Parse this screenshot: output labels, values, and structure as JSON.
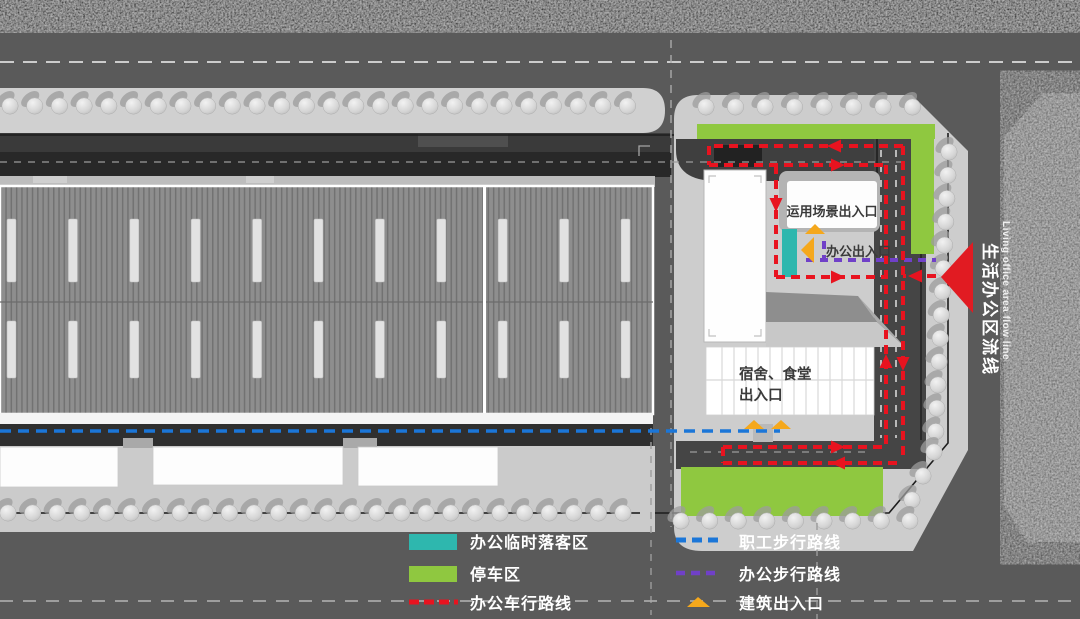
{
  "plan": {
    "labels": {
      "scene_entrance": "运用场景出入口",
      "office_entrance": "办公出入口",
      "dorm_line1": "宿舍、食堂",
      "dorm_line2": "出入口",
      "flow_cn": "生活办公区流线",
      "flow_en": "Living office area flow line"
    }
  },
  "legend": {
    "items_left": [
      {
        "label": "办公临时落客区",
        "swatch": "teal-rect",
        "color": "#2eb7ae"
      },
      {
        "label": "停车区",
        "swatch": "green-rect",
        "color": "#8fc840"
      },
      {
        "label": "办公车行路线",
        "swatch": "red-dashed-line",
        "color": "#e8131f"
      }
    ],
    "items_right": [
      {
        "label": "职工步行路线",
        "swatch": "blue-dashed-line",
        "color": "#1b76d8"
      },
      {
        "label": "办公步行路线",
        "swatch": "purple-dashed-line",
        "color": "#7040c8"
      },
      {
        "label": "建筑出入口",
        "swatch": "yellow-triangle",
        "color": "#f5a81c"
      }
    ]
  },
  "colors": {
    "drop_off_teal": "#2eb7ae",
    "parking_green": "#8fc840",
    "vehicle_route_red": "#e8131f",
    "staff_walk_blue": "#1b76d8",
    "office_walk_purple": "#7040c8",
    "entrance_yellow": "#f5a81c",
    "flow_arrow_red": "#e11b22"
  }
}
